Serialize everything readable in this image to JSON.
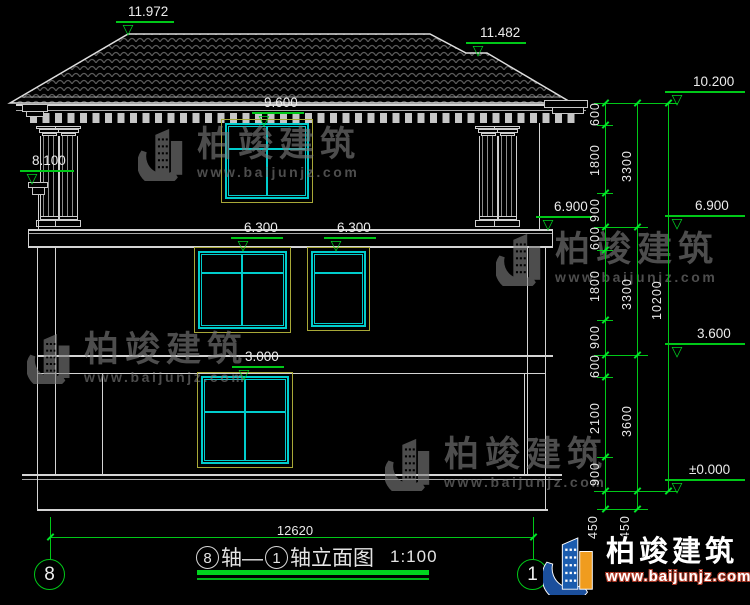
{
  "title": {
    "axis_start": "8",
    "connector": "轴—",
    "axis_end": "1",
    "suffix": "轴立面图",
    "scale": "1:100"
  },
  "axis_bubbles": {
    "left": "8",
    "right": "1"
  },
  "elevations": {
    "ridge_main": "11.972",
    "ridge_secondary": "11.482",
    "parapet_right": "10.200",
    "attic_window_head": "9.600",
    "corbel_left": "8.100",
    "level_floor3_wall": "6.900",
    "level_floor3_chain": "6.900",
    "window_head_left": "6.300",
    "window_head_right": "6.300",
    "level_floor2": "3.600",
    "window_head_ground": "3.000",
    "level_ground": "±0.000"
  },
  "dim_chains": {
    "inner": [
      "600",
      "1800",
      "900",
      "600",
      "1800",
      "900",
      "600",
      "2100",
      "900"
    ],
    "inner_below": [
      "450",
      "450"
    ],
    "middle": [
      "3300",
      "3300",
      "3600"
    ],
    "outer": [
      "10200"
    ],
    "width_total": "12620"
  },
  "watermark": {
    "brand": "柏竣建筑",
    "url": "www.baijunjz.com"
  },
  "logo": {
    "brand": "柏竣建筑",
    "url": "www.baijunjz.com"
  },
  "colors": {
    "dimension_green": "#00c818",
    "window_cyan": "#00cccc",
    "frame_yellow": "#a8a838",
    "line_white": "#d4d4d4",
    "logo_blue": "#1b5cae",
    "logo_orange": "#f09c1e",
    "logo_url_red": "#b03a28"
  }
}
